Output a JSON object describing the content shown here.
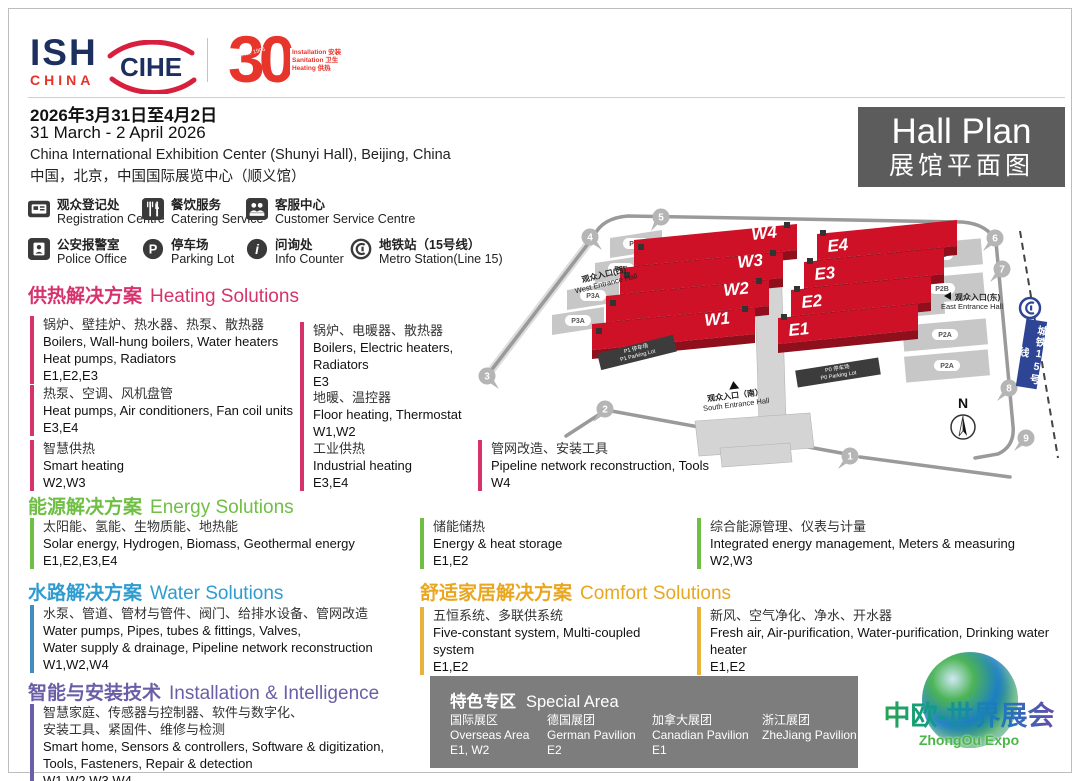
{
  "header": {
    "ish": "ISH",
    "ish_sub": "CHINA",
    "cihe": "CIHE",
    "anniv_number": "30",
    "anniv_since": "Since 1996",
    "anniv_lines": [
      "Installation 安装",
      "Sanitation 卫生",
      "Heating 供热"
    ],
    "date_cn": "2026年3月31日至4月2日",
    "date_en": "31 March - 2 April 2026",
    "venue_en": "China International Exhibition Center (Shunyi Hall), Beijing, China",
    "venue_cn": "中国，北京，中国国际展览中心（顺义馆）",
    "hall_plan_en": "Hall Plan",
    "hall_plan_cn": "展馆平面图"
  },
  "legend": [
    {
      "icon": "badge-icon",
      "cn": "观众登记处",
      "en": "Registration Centre"
    },
    {
      "icon": "utensils-icon",
      "cn": "餐饮服务",
      "en": "Catering Service"
    },
    {
      "icon": "people-desk-icon",
      "cn": "客服中心",
      "en": "Customer Service Centre"
    },
    {
      "icon": "police-icon",
      "cn": "公安报警室",
      "en": "Police Office"
    },
    {
      "icon": "parking-icon",
      "glyph": "P",
      "cn": "停车场",
      "en": "Parking Lot"
    },
    {
      "icon": "info-icon",
      "glyph": "i",
      "cn": "问询处",
      "en": "Info Counter"
    },
    {
      "icon": "metro-icon",
      "cn": "地铁站（15号线）",
      "en": "Metro Station(Line 15)"
    }
  ],
  "sections": {
    "heating": {
      "title_cn": "供热解决方案",
      "title_en": "Heating Solutions",
      "color": "#d6336c",
      "items": [
        {
          "cn": "锅炉、壁挂炉、热水器、热泵、散热器",
          "en": "Boilers, Wall-hung boilers, Water heaters\nHeat pumps, Radiators",
          "halls": "E1,E2,E3"
        },
        {
          "cn": "热泵、空调、风机盘管",
          "en": "Heat pumps, Air conditioners, Fan coil units",
          "halls": "E3,E4"
        },
        {
          "cn": "智慧供热",
          "en": "Smart heating",
          "halls": "W2,W3"
        },
        {
          "cn": "锅炉、电暖器、散热器",
          "en": "Boilers, Electric heaters, Radiators",
          "halls": "E3"
        },
        {
          "cn": "地暖、温控器",
          "en": "Floor heating, Thermostat",
          "halls": "W1,W2"
        },
        {
          "cn": "工业供热",
          "en": "Industrial heating",
          "halls": "E3,E4"
        },
        {
          "cn": "管网改造、安装工具",
          "en": "Pipeline network reconstruction, Tools",
          "halls": "W4"
        }
      ]
    },
    "energy": {
      "title_cn": "能源解决方案",
      "title_en": "Energy Solutions",
      "color": "#6fbf44",
      "items": [
        {
          "cn": "太阳能、氢能、生物质能、地热能",
          "en": "Solar energy, Hydrogen, Biomass, Geothermal energy",
          "halls": "E1,E2,E3,E4"
        },
        {
          "cn": "储能储热",
          "en": "Energy & heat storage",
          "halls": "E1,E2"
        },
        {
          "cn": "综合能源管理、仪表与计量",
          "en": "Integrated energy management, Meters & measuring",
          "halls": "W2,W3"
        }
      ]
    },
    "water": {
      "title_cn": "水路解决方案",
      "title_en": "Water Solutions",
      "color": "#2f9cd0",
      "items": [
        {
          "cn": "水泵、管道、管材与管件、阀门、给排水设备、管网改造",
          "en": "Water pumps, Pipes, tubes & fittings, Valves,\nWater supply & drainage, Pipeline network reconstruction",
          "halls": "W1,W2,W4"
        }
      ]
    },
    "comfort": {
      "title_cn": "舒适家居解决方案",
      "title_en": "Comfort Solutions",
      "color": "#e9a61f",
      "items": [
        {
          "cn": "五恒系统、多联供系统",
          "en": "Five-constant system, Multi-coupled system",
          "halls": "E1,E2"
        },
        {
          "cn": "新风、空气净化、净水、开水器",
          "en": "Fresh air, Air-purification, Water-purification, Drinking water heater",
          "halls": "E1,E2"
        }
      ]
    },
    "installation": {
      "title_cn": "智能与安装技术",
      "title_en": "Installation & Intelligence",
      "color": "#6a5fa7",
      "items": [
        {
          "cn": "智慧家庭、传感器与控制器、软件与数字化、\n安装工具、紧固件、维修与检测",
          "en": "Smart home, Sensors & controllers, Software & digitization,\nTools, Fasteners, Repair & detection",
          "halls": "W1,W2,W3,W4"
        }
      ]
    }
  },
  "special_area": {
    "title_cn": "特色专区",
    "title_en": "Special Area",
    "items": [
      {
        "cn": "国际展区",
        "en": "Overseas Area",
        "halls": "E1, W2"
      },
      {
        "cn": "德国展团",
        "en": "German Pavilion",
        "halls": "E2"
      },
      {
        "cn": "加拿大展团",
        "en": "Canadian Pavilion",
        "halls": "E1"
      },
      {
        "cn": "浙江展团",
        "en": "ZheJiang Pavilion",
        "halls": ""
      }
    ]
  },
  "map": {
    "hall_color": "#ce1126",
    "halls_west": [
      "W4",
      "W3",
      "W2",
      "W1"
    ],
    "halls_east": [
      "E4",
      "E3",
      "E2",
      "E1"
    ],
    "gates": [
      "1",
      "2",
      "3",
      "4",
      "5",
      "6",
      "7",
      "8",
      "9"
    ],
    "parking_left": [
      "P3B",
      "P3B",
      "P3A",
      "P3A"
    ],
    "parking_right": [
      "P2B",
      "P2B",
      "P2A",
      "P2A"
    ],
    "parking_p1_cn": "P1 停车场",
    "parking_p1_en": "P1 Parking Lot",
    "parking_p0_cn": "P0 停车场",
    "parking_p0_en": "P0 Parking Lot",
    "entrance_west_cn": "观众入口(西)",
    "entrance_west_en": "West Entrance Hall",
    "entrance_east_cn": "观众入口(东)",
    "entrance_east_en": "East Entrance Hall",
    "entrance_south_cn": "观众入口（南）",
    "entrance_south_en": "South Entrance Hall",
    "metro_label": "城铁15号线",
    "north": "N"
  },
  "footer_logo": {
    "cn": "中欧-世界展会",
    "en": "ZhongOu Expo"
  }
}
